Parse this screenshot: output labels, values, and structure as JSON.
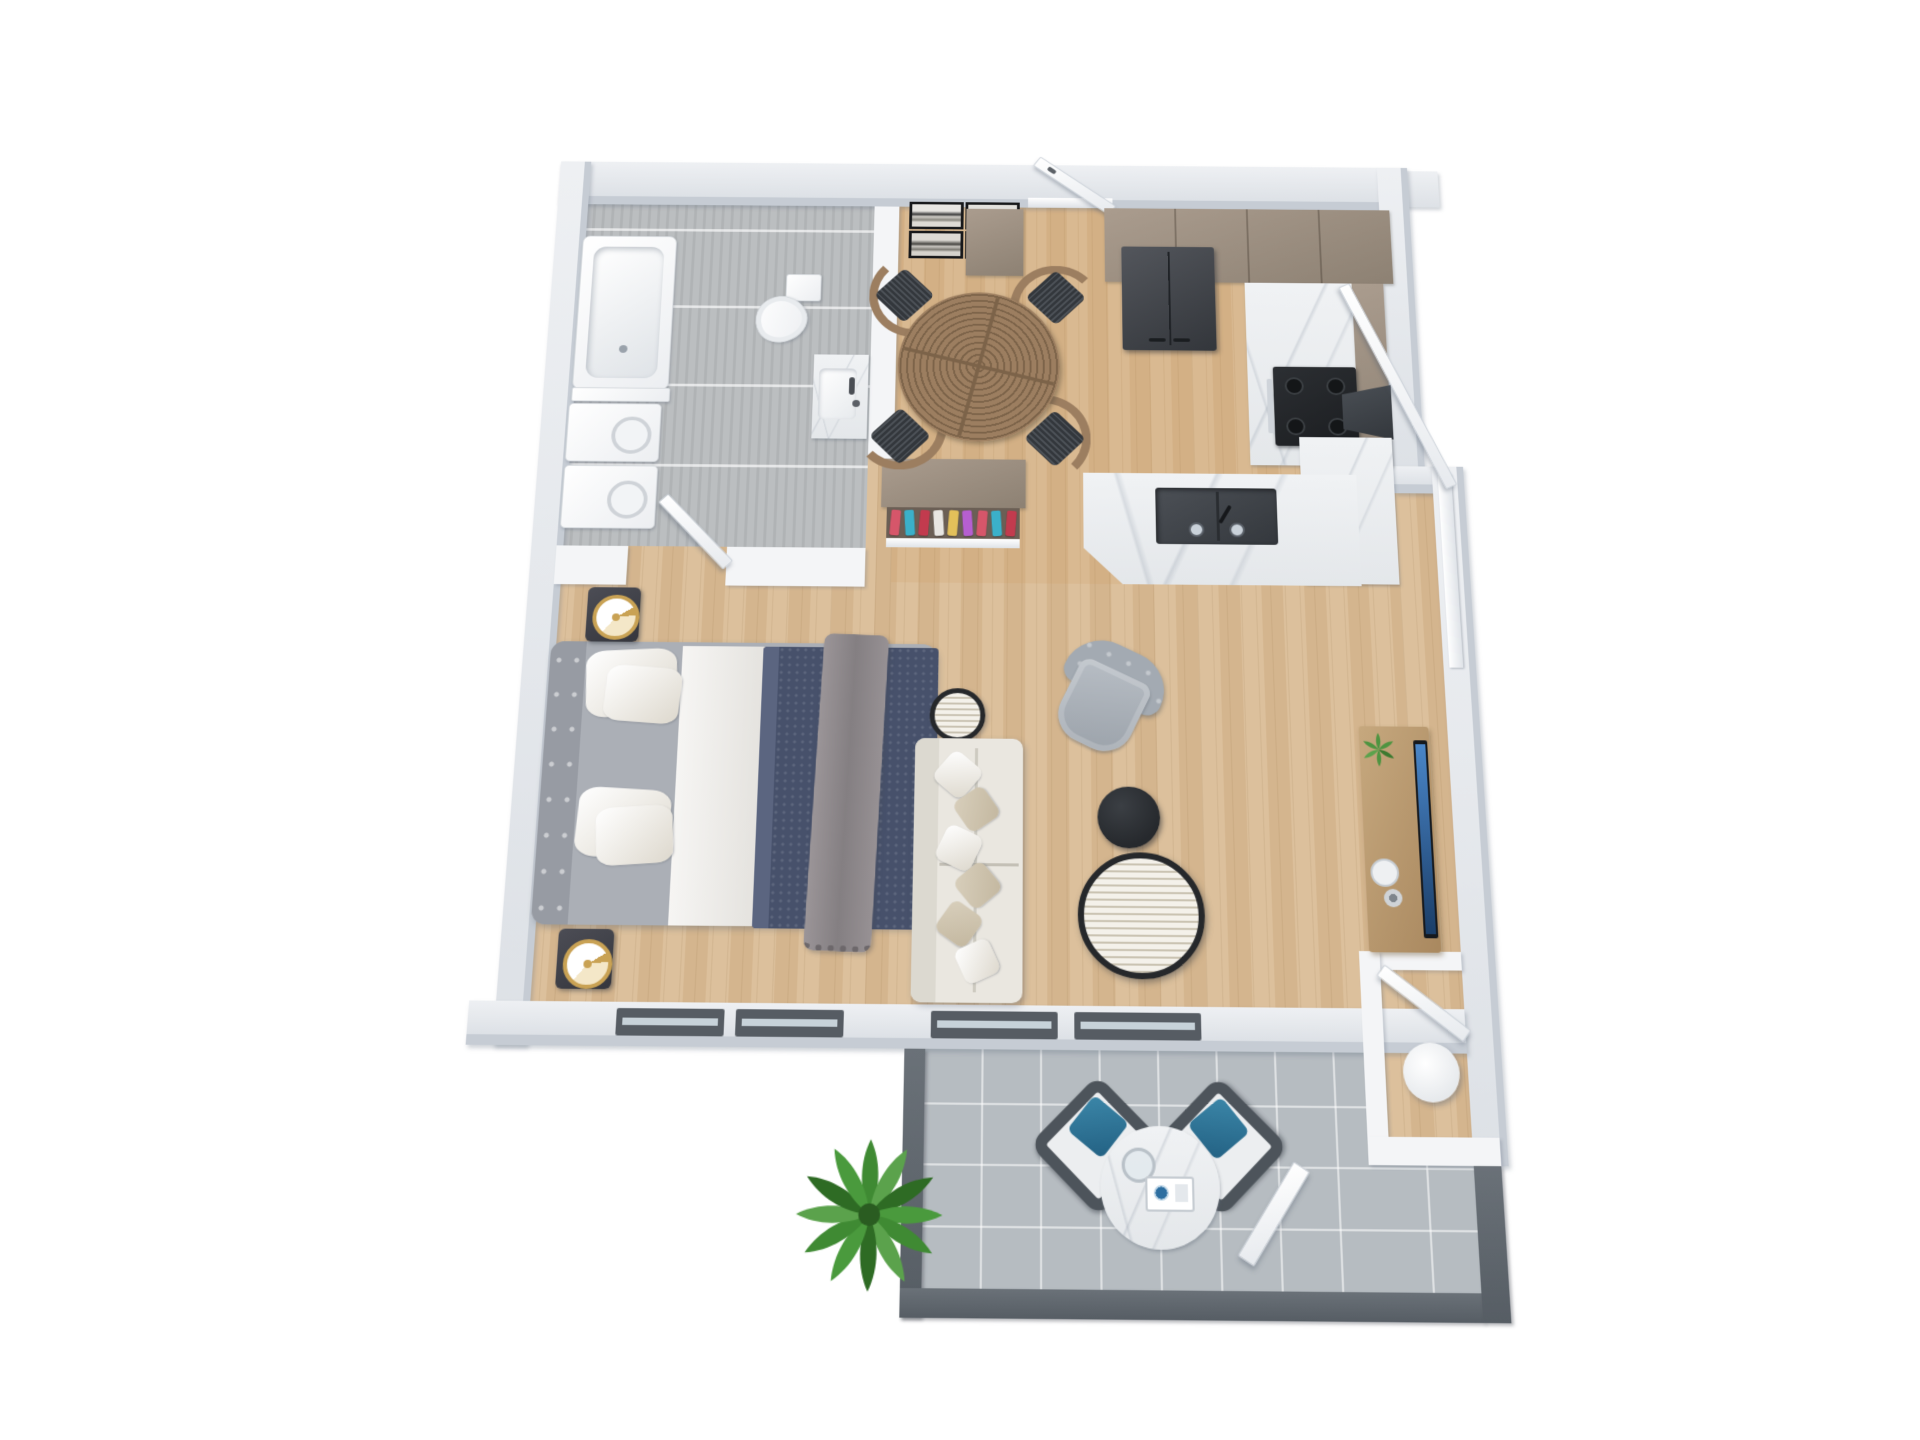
{
  "scene": {
    "type": "3d-floor-plan-render",
    "view": "top-down axonometric",
    "description": "Photoreal 3D floor plan of a one-bedroom apartment with bathroom, dining nook, open kitchen, bedroom/living area, entry nook and tiled balcony patio",
    "background": "#ffffff"
  },
  "palette": {
    "bg": "#ffffff",
    "wallTop": "#eef0f3",
    "wallTop2": "#dde1e6",
    "wallFace": "#c6ccd4",
    "part": "#f4f5f7",
    "wood": "#dcc09c",
    "wood2": "#d4b58e",
    "tileA": "#bbbec0",
    "tileB": "#b0b3b5",
    "patio": "#b6bcc1",
    "patioWall": "#6a7178",
    "patioWall2": "#565d64",
    "winFrame": "#565c63",
    "winGlass": "#c7d2d9",
    "cab": "#aa9c8e",
    "cabD": "#8d8173",
    "fridge": "#43464c",
    "stove": "#26282b",
    "hood": "#3c4046",
    "sink": "#43474d",
    "tableWood": "#9c7e60",
    "tableWoodD": "#7c6349",
    "chairCushion": "#32363b",
    "bedFrame": "#abafb6",
    "headboard": "#979ba3",
    "duvet": "#47516b",
    "duvetFold": "#5b6580",
    "throw": "#8f8a8d",
    "sofa": "#eae7e0",
    "sofaBack": "#dcd9d0",
    "armchair": "#a3aab2",
    "armchairSeat": "#b8bec5",
    "coffeeBlack": "#2b2e32",
    "rim": "#26282b",
    "console": "#c6a87e",
    "consoleD": "#a9885f",
    "tv": "#16191d",
    "tvScreen1": "#4a86c8",
    "tvScreen2": "#1b3e68",
    "gold": "#c9a254",
    "plant": "#3f8a33",
    "plantD": "#2e6b24",
    "patioChair": "#4d545b",
    "patioPillow": "#2d7394"
  },
  "closet": {
    "clothes_colors": [
      "#d6566a",
      "#3bb0c9",
      "#c23b4e",
      "#e8e6e2",
      "#e3c05a",
      "#b65fd0",
      "#d6566a",
      "#3bb0c9",
      "#c23b4e"
    ]
  },
  "rooms": [
    {
      "id": "bathroom",
      "floor": "gray plank tile"
    },
    {
      "id": "dining-nook",
      "floor": "light oak wood"
    },
    {
      "id": "kitchen",
      "floor": "light oak wood"
    },
    {
      "id": "bedroom-living",
      "floor": "light oak wood"
    },
    {
      "id": "entry-nook",
      "floor": "light oak wood"
    },
    {
      "id": "patio",
      "floor": "gray square tile"
    }
  ],
  "furniture": {
    "bathroom": [
      "bathtub",
      "stacked washer",
      "stacked dryer",
      "toilet",
      "marble vanity sink"
    ],
    "dining": [
      "round ring-top table",
      "4 wood chairs with striped cushions",
      "4 framed artworks",
      "wardrobe with hanging clothes"
    ],
    "kitchen": [
      "entry door",
      "shoe cabinet",
      "french-door refrigerator",
      "upper cabinets",
      "marble counter",
      "gas stove",
      "range hood",
      "island with double sink"
    ],
    "bedroom": [
      "double bed with navy duvet and gray throw",
      "2 nightstands with gold lamps"
    ],
    "living": [
      "cream sofa with pillows",
      "round side table",
      "gray tufted armchair",
      "black round coffee table",
      "striped round coffee table",
      "media console",
      "wall TV",
      "potted plant",
      "plate",
      "vase"
    ],
    "entry_nook": [
      "interior door",
      "round white stool"
    ],
    "patio": [
      "2 wicker chairs with blue pillows",
      "round marble bistro table",
      "glass",
      "serving tray",
      "large green plant",
      "exterior door",
      "sliding balcony door"
    ]
  }
}
